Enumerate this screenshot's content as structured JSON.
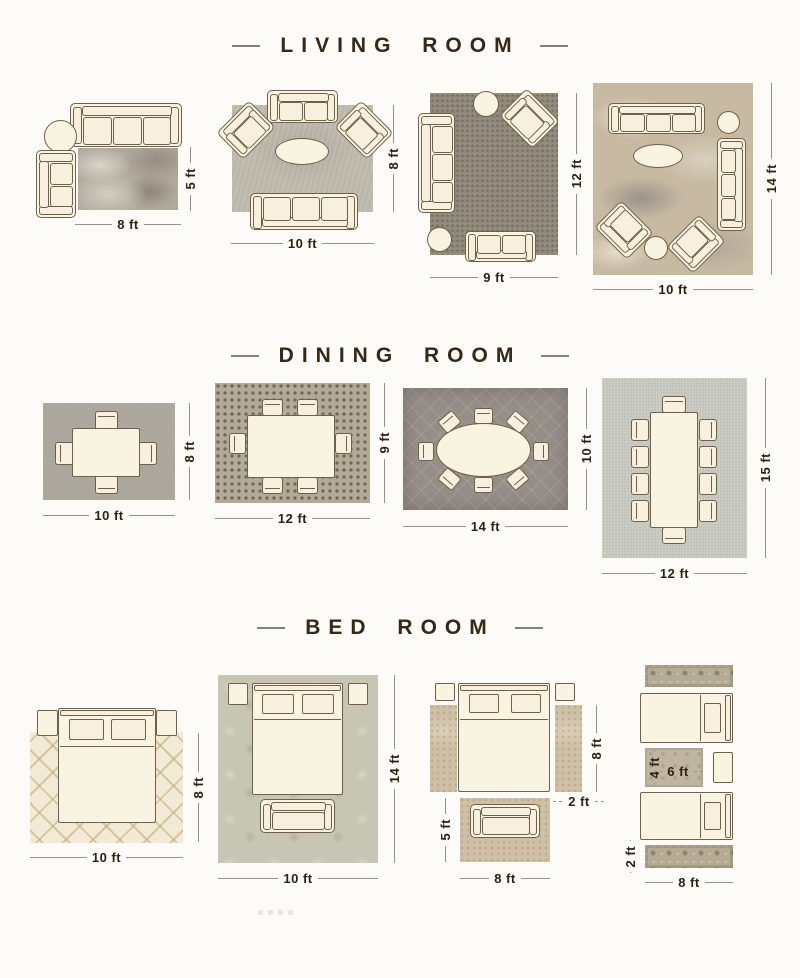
{
  "page": {
    "background": "#fcfbf7"
  },
  "colors": {
    "title_text": "#362818",
    "dimension_text": "#2b2115",
    "dimension_line": "#94908a",
    "furniture_fill": "#f9f3e2",
    "furniture_outline": "#70604a"
  },
  "sections": [
    {
      "id": "living-room",
      "title": "LIVING ROOM",
      "layouts": [
        {
          "name": "living-rug-8x5",
          "width_label": "8 ft",
          "height_label": "5 ft"
        },
        {
          "name": "living-rug-10x8",
          "width_label": "10 ft",
          "height_label": "8 ft"
        },
        {
          "name": "living-rug-9x12",
          "width_label": "9 ft",
          "height_label": "12 ft"
        },
        {
          "name": "living-rug-10x14",
          "width_label": "10 ft",
          "height_label": "14 ft"
        }
      ]
    },
    {
      "id": "dining-room",
      "title": "DINING ROOM",
      "layouts": [
        {
          "name": "dining-rug-10x8",
          "width_label": "10 ft",
          "height_label": "8 ft"
        },
        {
          "name": "dining-rug-12x9",
          "width_label": "12 ft",
          "height_label": "9 ft"
        },
        {
          "name": "dining-rug-14x10",
          "width_label": "14 ft",
          "height_label": "10 ft"
        },
        {
          "name": "dining-rug-12x15",
          "width_label": "12 ft",
          "height_label": "15 ft"
        }
      ]
    },
    {
      "id": "bed-room",
      "title": "BED ROOM",
      "layouts": [
        {
          "name": "bed-rug-10x8",
          "width_label": "10 ft",
          "height_label": "8 ft"
        },
        {
          "name": "bed-rug-10x14",
          "width_label": "10 ft",
          "height_label": "14 ft"
        },
        {
          "name": "bed-runners-and-foot-rug",
          "runner_length_label": "8 ft",
          "runner_width_label": "2 ft",
          "foot_rug_height_label": "5 ft",
          "foot_rug_width_label": "8 ft"
        },
        {
          "name": "twin-beds-runners",
          "mid_rug_height_label": "4 ft",
          "mid_rug_width_label": "6 ft",
          "runner_width_label": "2 ft",
          "runner_length_label": "8 ft"
        }
      ]
    }
  ]
}
